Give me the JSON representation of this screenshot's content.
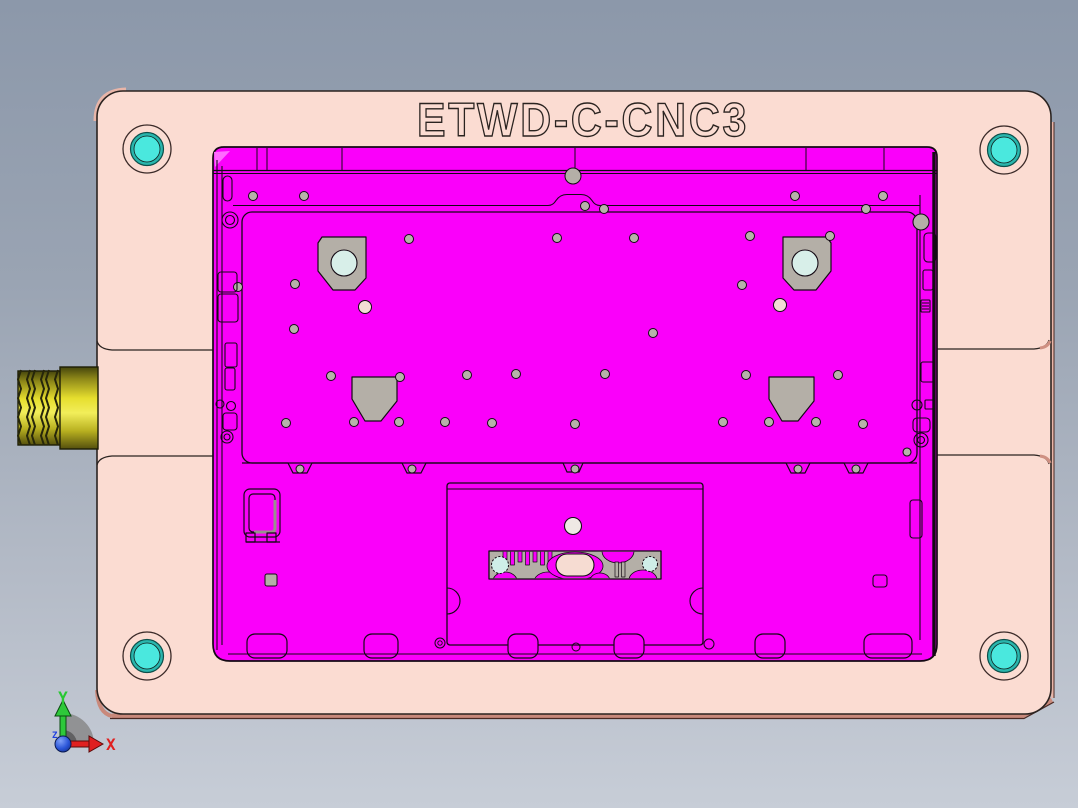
{
  "viewport": {
    "width": 1078,
    "height": 808,
    "bg_top": "#8c98aa",
    "bg_bottom": "#c7cdd7"
  },
  "title": {
    "text": "ETWD-C-CNC3"
  },
  "plate": {
    "fill": "#fbdcd2",
    "edge_side": "#c9897b",
    "edge_light": "#e8b5a8",
    "outline": "#2a2320",
    "bolts": [
      {
        "cx": 147,
        "cy": 149
      },
      {
        "cx": 1004,
        "cy": 150
      },
      {
        "cx": 147,
        "cy": 656
      },
      {
        "cx": 1004,
        "cy": 656
      }
    ],
    "bolt_outer_r": 24,
    "bolt_ring_r": 16.5,
    "bolt_core_r": 13,
    "bolt_ring_fill": "#29b6ad",
    "bolt_core_fill": "#4ae8de"
  },
  "rod": {
    "thread_xs": [
      21,
      28,
      35,
      42,
      49,
      56
    ],
    "dark": "#4a4a0e",
    "bright": "#f2ee5a",
    "mid": "#e6de2e"
  },
  "part": {
    "fill": "#fa00fa",
    "highlight": "#ff6bff",
    "outline": "#140a14",
    "pad_fill": "#b4afa7",
    "pad_circle_fill": "#d8efe9",
    "dot_fill": "#b7b2aa",
    "soft_dot_fill": "#f3ddd5",
    "hinge_dividers": [
      257,
      267,
      342,
      575,
      806,
      884
    ],
    "pads": [
      {
        "points": "322,237 366,237 366,278 355,290 333,290 318,271 318,243",
        "circle": [
          344,
          263,
          13
        ]
      },
      {
        "points": "783,237 827,237 831,243 831,271 816,290 794,290 783,278",
        "circle": [
          805,
          263,
          13
        ]
      },
      {
        "points": "352,377 397,377 397,401 381,421 365,421 352,399",
        "circle": null
      },
      {
        "points": "769,377 814,377 814,401 798,421 782,421 769,399",
        "circle": null
      }
    ],
    "screw_dots": [
      [
        253,
        196
      ],
      [
        304,
        196
      ],
      [
        795,
        196
      ],
      [
        883,
        196
      ],
      [
        409,
        239
      ],
      [
        557,
        238
      ],
      [
        634,
        238
      ],
      [
        750,
        236
      ],
      [
        830,
        236
      ],
      [
        866,
        209
      ],
      [
        238,
        287
      ],
      [
        295,
        284
      ],
      [
        742,
        285
      ],
      [
        294,
        329
      ],
      [
        653,
        333
      ],
      [
        331,
        376
      ],
      [
        400,
        377
      ],
      [
        467,
        375
      ],
      [
        516,
        374
      ],
      [
        605,
        374
      ],
      [
        746,
        375
      ],
      [
        838,
        375
      ],
      [
        286,
        423
      ],
      [
        354,
        422
      ],
      [
        399,
        422
      ],
      [
        445,
        422
      ],
      [
        492,
        423
      ],
      [
        575,
        424
      ],
      [
        723,
        422
      ],
      [
        769,
        422
      ],
      [
        816,
        422
      ],
      [
        863,
        424
      ],
      [
        585,
        206
      ],
      [
        604,
        209
      ]
    ],
    "soft_dots": [
      [
        365,
        307
      ],
      [
        780,
        305
      ]
    ],
    "bump_dots": [
      [
        300,
        469
      ],
      [
        412,
        469
      ],
      [
        575,
        469
      ],
      [
        798,
        469
      ],
      [
        856,
        469
      ]
    ],
    "bottom_tabs": [
      {
        "x": 247,
        "w": 40
      },
      {
        "x": 364,
        "w": 34
      },
      {
        "x": 508,
        "w": 30
      },
      {
        "x": 614,
        "w": 30
      },
      {
        "x": 755,
        "w": 30
      },
      {
        "x": 864,
        "w": 48
      }
    ],
    "strip": {
      "teeth_count": 7,
      "teeth_x0": 503,
      "teeth_step": 7.5,
      "gray": "#b4afa7",
      "cyan": "#cfeee8",
      "oval_fill": "#f6dcd2"
    }
  },
  "triad": {
    "x_label": "X",
    "y_label": "Y",
    "z_label": "Z",
    "x_color": "#e02020",
    "y_color": "#28c832",
    "z_color": "#2040e0",
    "origin_color": "#2a55d8"
  }
}
